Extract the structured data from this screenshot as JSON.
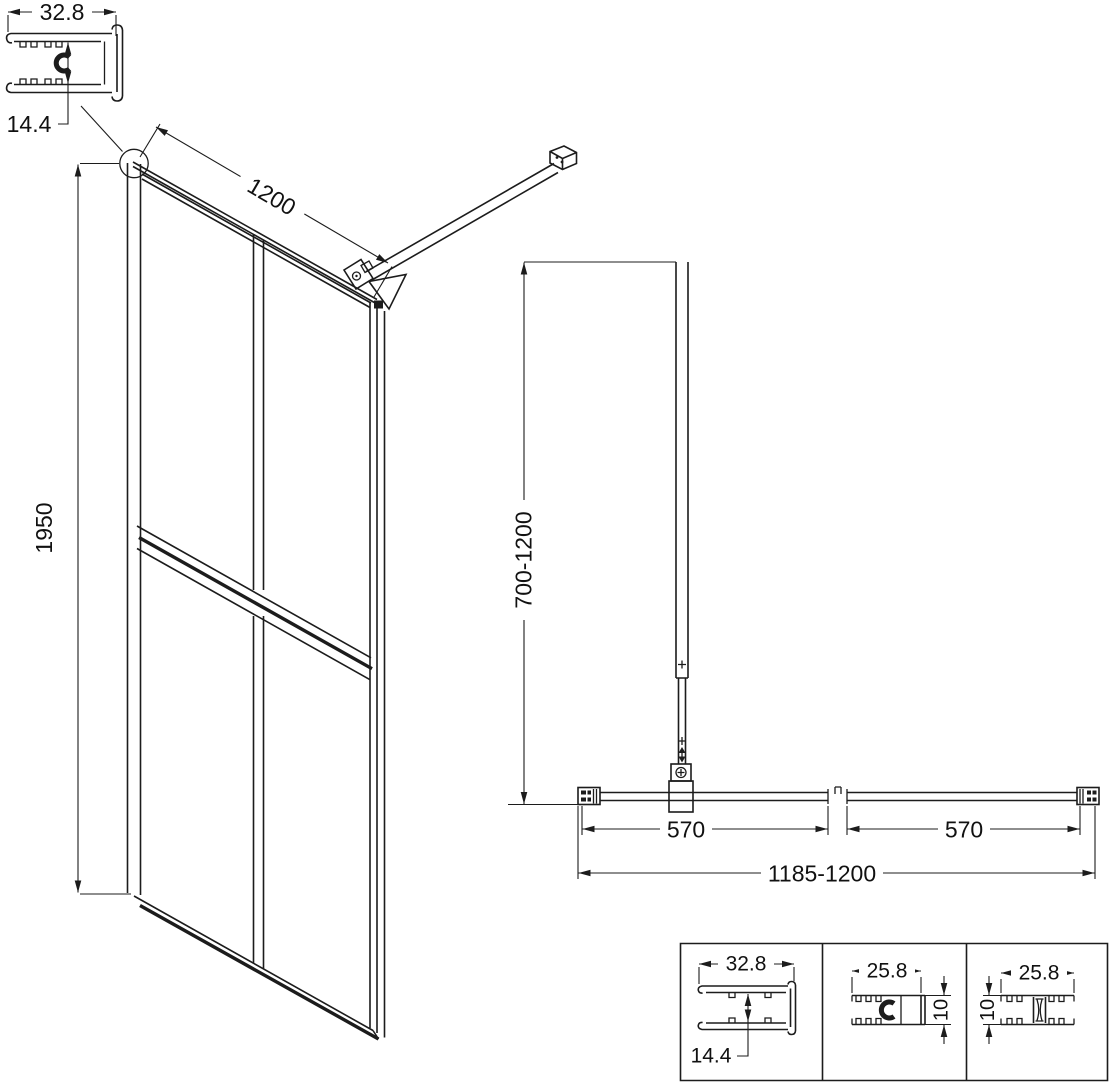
{
  "background_color": "#ffffff",
  "line_color": "#1c1c1c",
  "corner_profile": {
    "width_mm": "32.8",
    "channel_depth_mm": "14.4"
  },
  "front_view": {
    "width_mm": "1200",
    "height_mm": "1950"
  },
  "plan_view": {
    "arm_length_range_mm": "700-1200",
    "left_span_mm": "570",
    "right_span_mm": "570",
    "overall_width_mm": "1185-1200"
  },
  "profile_table": {
    "wall_profile": {
      "width_mm": "32.8",
      "channel_depth_mm": "14.4"
    },
    "c_profile": {
      "width_mm": "25.8",
      "height_mm": "10"
    },
    "flat_profile": {
      "width_mm": "25.8",
      "height_mm": "10"
    }
  }
}
